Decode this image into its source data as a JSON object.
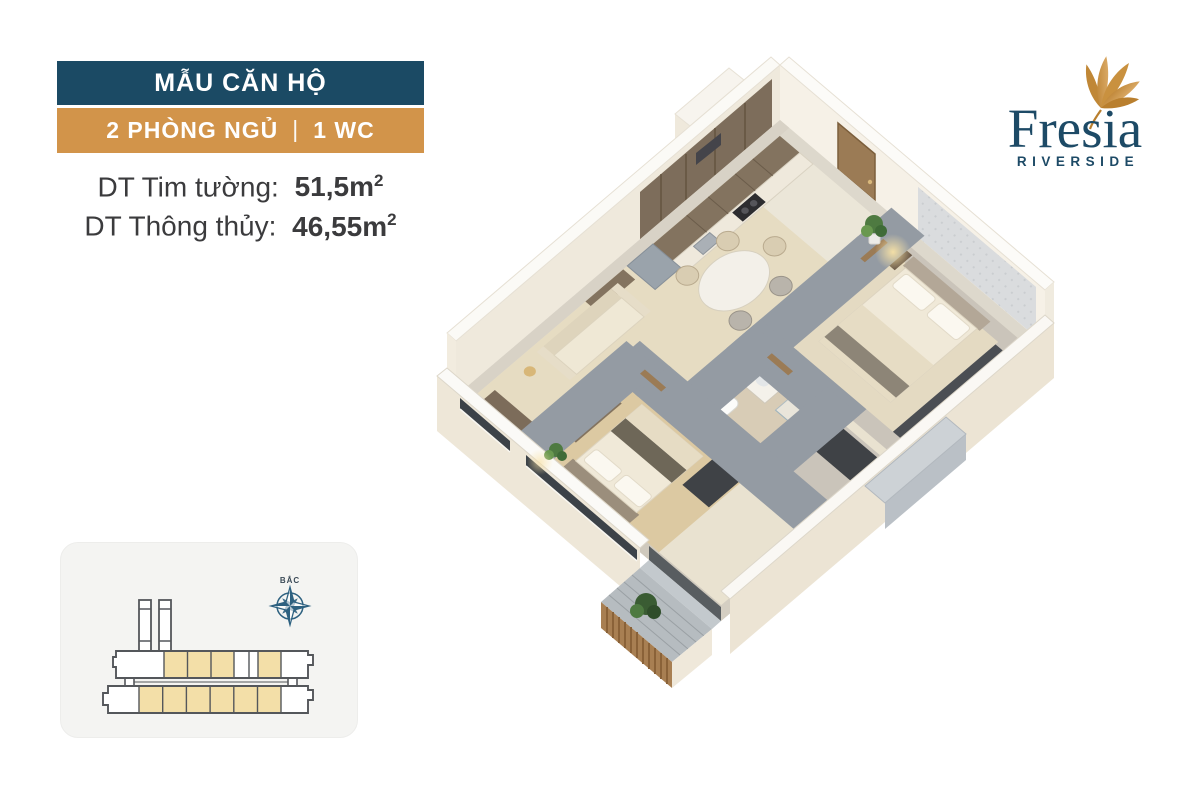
{
  "header": {
    "model_label": "MẪU CĂN HỘ",
    "config": {
      "bedrooms": "2 PHÒNG NGỦ",
      "separator": "|",
      "wc": "1 WC"
    },
    "areas": [
      {
        "label": "DT Tim tường:",
        "value": "51,5m",
        "sup": "2"
      },
      {
        "label": "DT Thông thủy:",
        "value": "46,55m",
        "sup": "2"
      }
    ],
    "colors": {
      "model_bg": "#1b4a64",
      "config_bg": "#d2944a",
      "banner_text": "#ffffff",
      "area_text": "#3b3b3d"
    }
  },
  "logo": {
    "brand": "Fresia",
    "tagline": "RIVERSIDE",
    "text_color": "#1d4a66",
    "flower_gold": "#c9913f"
  },
  "floorplan": {
    "type": "isometric-3d-cutaway-apartment",
    "palette": {
      "outer_wall_face": "#f3eee3",
      "wall_top": "#fbfaf7",
      "partition_top": "#a7aeb6",
      "floor_base": "#e9e2d0",
      "floor_wood": "#dcc9a2",
      "floor_tile": "#eae4d4",
      "cabinet_wood": "#83735f",
      "door_wood": "#9b7b55",
      "wardrobe_dark": "#3f4246",
      "glass_dark": "#3c4248",
      "balcony_slats": "#a87f52",
      "plant_green": "#4e7a41",
      "lamp_glow": "#f8e2a6"
    }
  },
  "sitemap": {
    "compass_label": "BẮC",
    "colors": {
      "card_bg": "#f4f4f2",
      "outline": "#54575b",
      "unit_highlight": "#f3dfa8",
      "compass": "#2e6180"
    }
  }
}
